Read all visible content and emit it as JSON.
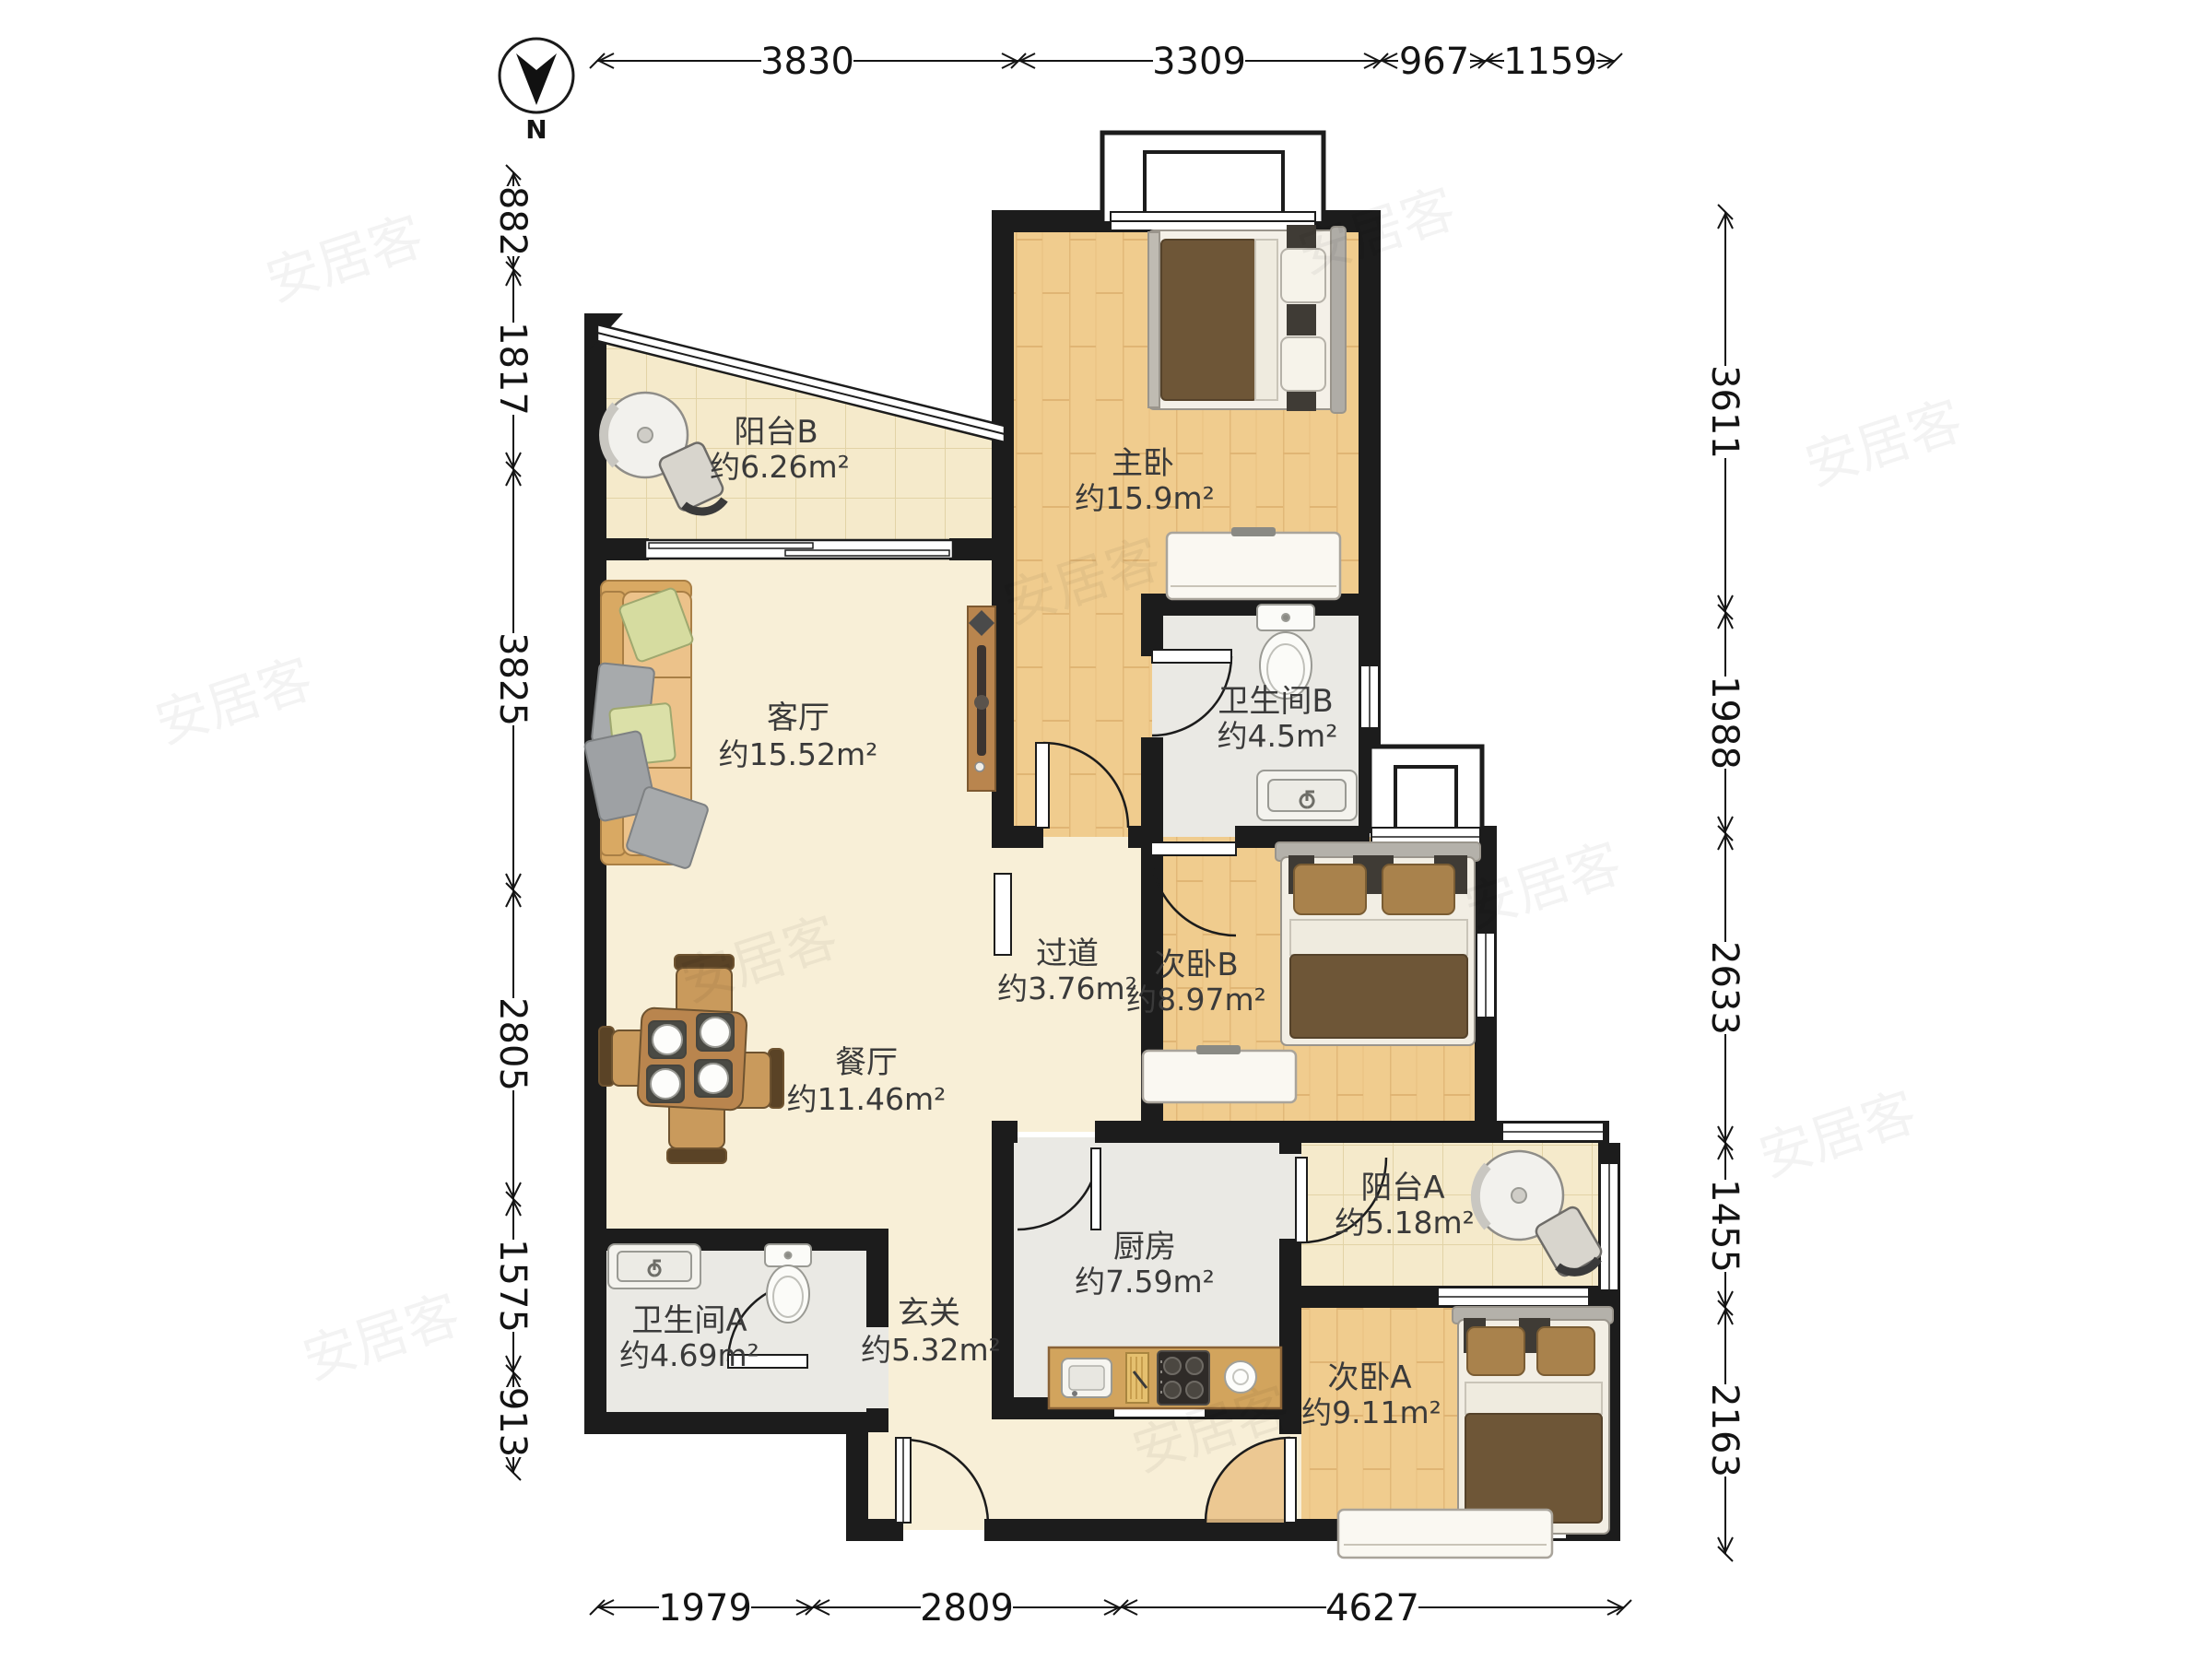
{
  "compass": {
    "label": "N"
  },
  "watermark": {
    "text": "安居客"
  },
  "rooms": [
    {
      "id": "balcony-b",
      "name": "阳台B",
      "area": "约6.26m²"
    },
    {
      "id": "master-bedroom",
      "name": "主卧",
      "area": "约15.9m²"
    },
    {
      "id": "living-room",
      "name": "客厅",
      "area": "约15.52m²"
    },
    {
      "id": "bathroom-b",
      "name": "卫生间B",
      "area": "约4.5m²"
    },
    {
      "id": "hallway",
      "name": "过道",
      "area": "约3.76m²"
    },
    {
      "id": "bedroom-b",
      "name": "次卧B",
      "area": "约8.97m²"
    },
    {
      "id": "dining-room",
      "name": "餐厅",
      "area": "约11.46m²"
    },
    {
      "id": "bathroom-a",
      "name": "卫生间A",
      "area": "约4.69m²"
    },
    {
      "id": "kitchen",
      "name": "厨房",
      "area": "约7.59m²"
    },
    {
      "id": "entry",
      "name": "玄关",
      "area": "约5.32m²"
    },
    {
      "id": "balcony-a",
      "name": "阳台A",
      "area": "约5.18m²"
    },
    {
      "id": "bedroom-a",
      "name": "次卧A",
      "area": "约9.11m²"
    }
  ],
  "dimensions": {
    "top": [
      "3830",
      "3309",
      "967",
      "1159"
    ],
    "bottom": [
      "1979",
      "2809",
      "4627"
    ],
    "left": [
      "882",
      "1817",
      "3825",
      "2805",
      "1575",
      "913"
    ],
    "right": [
      "3611",
      "1988",
      "2633",
      "1455",
      "2163"
    ]
  },
  "colors": {
    "wall": "#1c1c1c",
    "wood_floor": "#f0cc8e",
    "tile_floor": "#f5eacb",
    "stone_cream": "#f8efd7",
    "stone_grey": "#eae9e4",
    "furniture_wood": "#c99a5c",
    "bedding_brown": "#6e5637",
    "label_text": "#3a3a3a"
  }
}
